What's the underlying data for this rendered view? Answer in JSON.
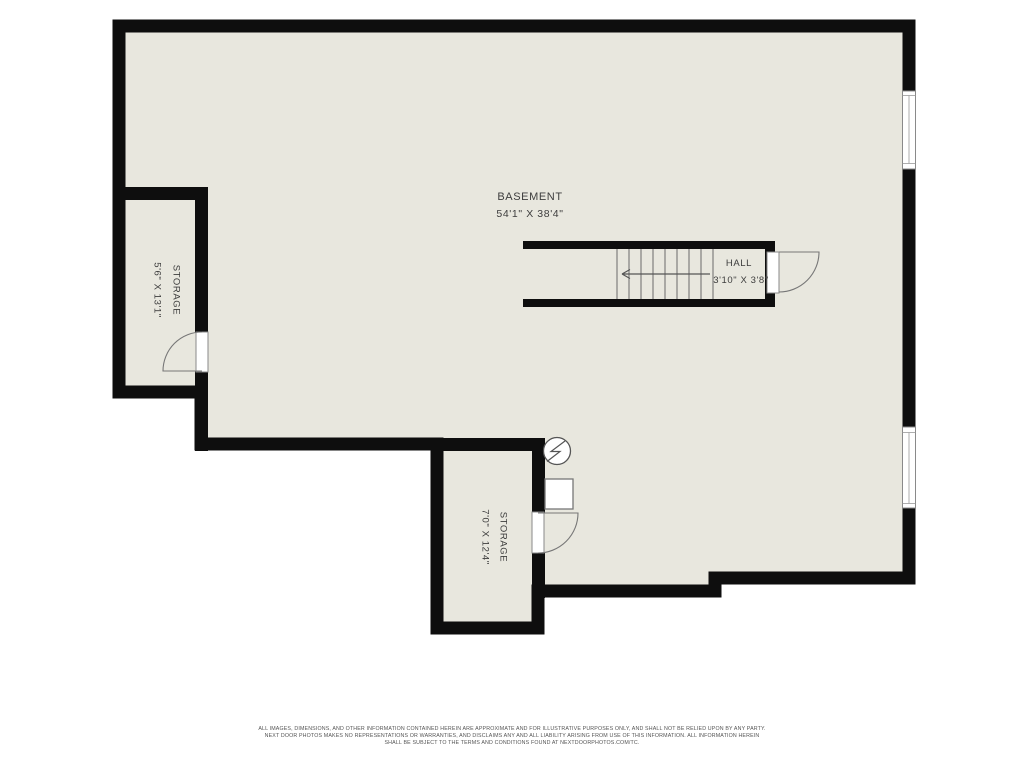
{
  "plan": {
    "type": "basement-floor-plan",
    "rooms": {
      "basement": {
        "name": "BASEMENT",
        "dims": "54'1\" X 38'4\""
      },
      "hall": {
        "name": "HALL",
        "dims": "3'10\" X 3'8\""
      },
      "storage_left": {
        "name": "STORAGE",
        "dims": "5'6\" X 13'1\""
      },
      "storage_bottom": {
        "name": "STORAGE",
        "dims": "7'0\" X 12'4\""
      }
    },
    "symbols": {
      "electrical": "electrical-meter-symbol",
      "appliance": "appliance-square-symbol",
      "stairs_direction": "left"
    },
    "features": {
      "windows_right_wall": 2,
      "doors": 3,
      "stair_risers": 9
    }
  },
  "colors": {
    "background": "#ffffff",
    "floor": "#e8e7de",
    "wall": "#0e0e0e",
    "label": "#3d3d3d",
    "line": "#6a6a6a"
  },
  "footer": {
    "line1": "ALL IMAGES, DIMENSIONS, AND OTHER INFORMATION CONTAINED HEREIN ARE APPROXIMATE AND FOR ILLUSTRATIVE PURPOSES ONLY, AND SHALL NOT BE RELIED UPON BY ANY PARTY.",
    "line2": "NEXT DOOR PHOTOS MAKES NO REPRESENTATIONS OR WARRANTIES, AND DISCLAIMS ANY AND ALL LIABILITY ARISING FROM USE OF THIS INFORMATION. ALL INFORMATION HEREIN",
    "line3": "SHALL BE SUBJECT TO THE TERMS AND CONDITIONS FOUND AT NEXTDOORPHOTOS.COM/TC."
  }
}
